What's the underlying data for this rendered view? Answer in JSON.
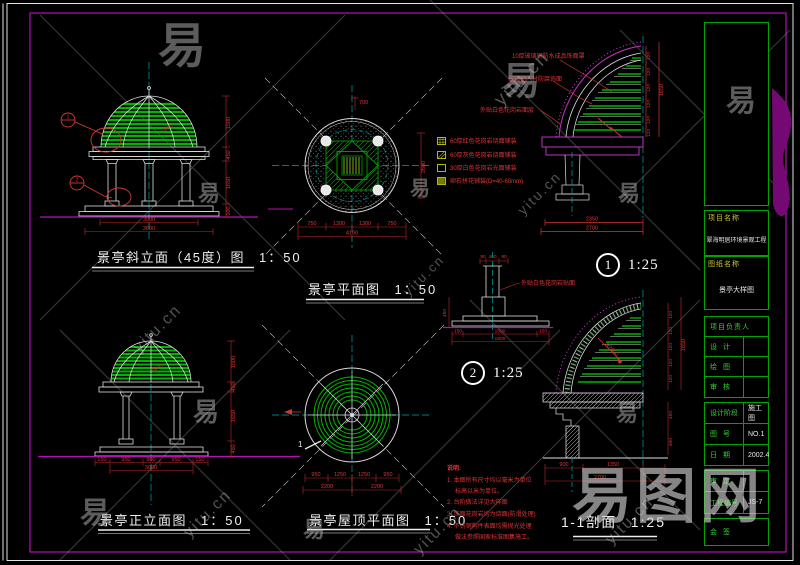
{
  "watermark": {
    "char": "易",
    "url": "yitu.cn",
    "brand": "易图网"
  },
  "titles": {
    "oblique": {
      "text": "景亭斜立面（45度）图",
      "scale": "1：50"
    },
    "plan": {
      "text": "景亭平面图",
      "scale": "1：50"
    },
    "front": {
      "text": "景亭正立面图",
      "scale": "1：50"
    },
    "roof": {
      "text": "景亭屋顶平面图",
      "scale": "1：50"
    },
    "section": {
      "text": "1-1剖面",
      "scale": "1:25"
    },
    "detail1": {
      "num": "1",
      "scale": "1:25"
    },
    "detail2": {
      "num": "2",
      "scale": "1:25"
    }
  },
  "legend": {
    "items": [
      "60厚红色花岗岩烧面铺装",
      "60厚灰色花岗岩烧面铺装",
      "30厚白色花岗岩光面铺装",
      "卵石拼花铺装(D=40-60mm)"
    ]
  },
  "notes": {
    "heading": "说明:",
    "lines": [
      "1. 本图所有尺寸均以毫米为单位",
      "   标高以米为单位。",
      "2. 台阶做法详见大样图",
      "3. 饰面花岗岩均为烧面(防滑处理)",
      "4. 不锈钢构件表面均需抛光处理",
      "   做法参照国家标准图集施工。"
    ]
  },
  "callouts": {
    "d1a": "10厚玻璃钢防水成品饰面罩",
    "d1b": "玻璃钢内衬防腐饰面",
    "d1c": "外贴白色花岗岩面层",
    "d2a": "外贴白色花岗岩贴面",
    "sec_r": "R2600",
    "dome": "2600"
  },
  "dims": {
    "lv": "120",
    "bracket": "1650",
    "oblique_v": [
      "1500",
      "450",
      "1650",
      "500"
    ],
    "oblique_b": [
      "3000",
      "3600"
    ],
    "front_v": [
      "1500",
      "450",
      "1650",
      "450"
    ],
    "front_b": [
      "150",
      "950",
      "800",
      "950",
      "150",
      "3000"
    ],
    "plan_b": [
      "750",
      "1300",
      "1300",
      "750",
      "4100"
    ],
    "plan_r": "2600",
    "plan_t": "700",
    "roof_b": [
      "950",
      "1250",
      "1250",
      "950",
      "2200",
      "2200"
    ],
    "d1_b": [
      "2350",
      "2700"
    ],
    "d2_t": [
      "90",
      "400",
      "90"
    ],
    "d2_b": [
      "150",
      "1500",
      "150",
      "1800"
    ],
    "d2_l": "450",
    "sec_b": [
      "900",
      "1350",
      "2700"
    ],
    "sec_extra": [
      "450",
      "600"
    ],
    "marker1": "1",
    "marker2": "2",
    "cut1": "1"
  },
  "title_block": {
    "project_label": "项目名称",
    "project_name": "翠海明居环境景观工程",
    "sheet_label": "图纸名称",
    "sheet_name": "景亭大样图",
    "rows": [
      {
        "label": "项目负责人",
        "value": ""
      },
      {
        "label": "设  计",
        "value": ""
      },
      {
        "label": "绘  图",
        "value": ""
      },
      {
        "label": "审  核",
        "value": ""
      },
      {
        "label": "设计阶段",
        "value": "施工图"
      },
      {
        "label": "图  号",
        "value": "NO.1"
      },
      {
        "label": "日  期",
        "value": "2002.4"
      },
      {
        "label": "审  定",
        "value": ""
      },
      {
        "label": "工程编号",
        "value": "JS-7"
      },
      {
        "label": "会  签",
        "value": ""
      }
    ]
  }
}
